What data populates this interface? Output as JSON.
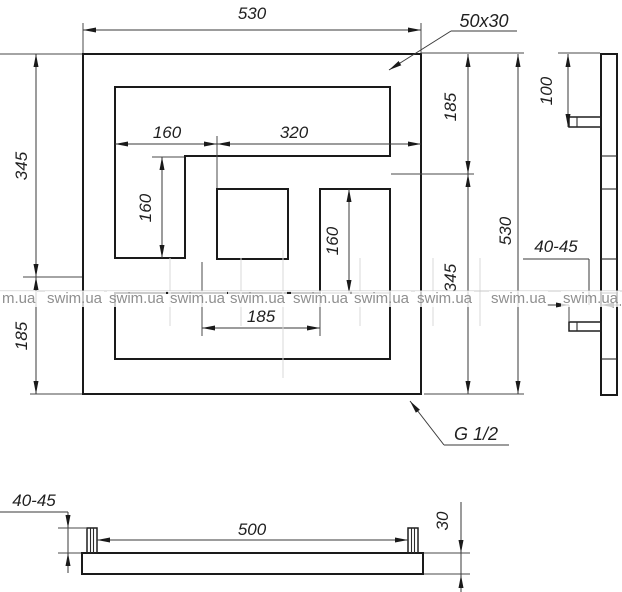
{
  "front_view": {
    "dim_width_top": "530",
    "dim_height_left_upper": "345",
    "dim_height_left_lower": "185",
    "dim_inner_left": "160",
    "dim_inner_right": "320",
    "dim_left_slot_height": "160",
    "dim_right_slot_height": "160",
    "dim_bottom_width": "185",
    "dim_right_upper": "185",
    "dim_right_height": "530",
    "dim_right_lower": "345",
    "callout_profile": "50x30",
    "callout_connection": "G 1/2"
  },
  "side_view": {
    "dim_top_offset": "100",
    "dim_wall_clearance": "40-45"
  },
  "bottom_view": {
    "dim_wall_clearance": "40-45",
    "dim_bracket_span": "500",
    "dim_tube_depth": "30"
  },
  "watermark": {
    "items": [
      "m.ua",
      "swim.ua",
      "swim.ua",
      "swim.ua",
      "swim.ua",
      "swim.ua",
      "swim.ua",
      "swim.ua",
      "swim.ua",
      "swim.ua"
    ]
  }
}
